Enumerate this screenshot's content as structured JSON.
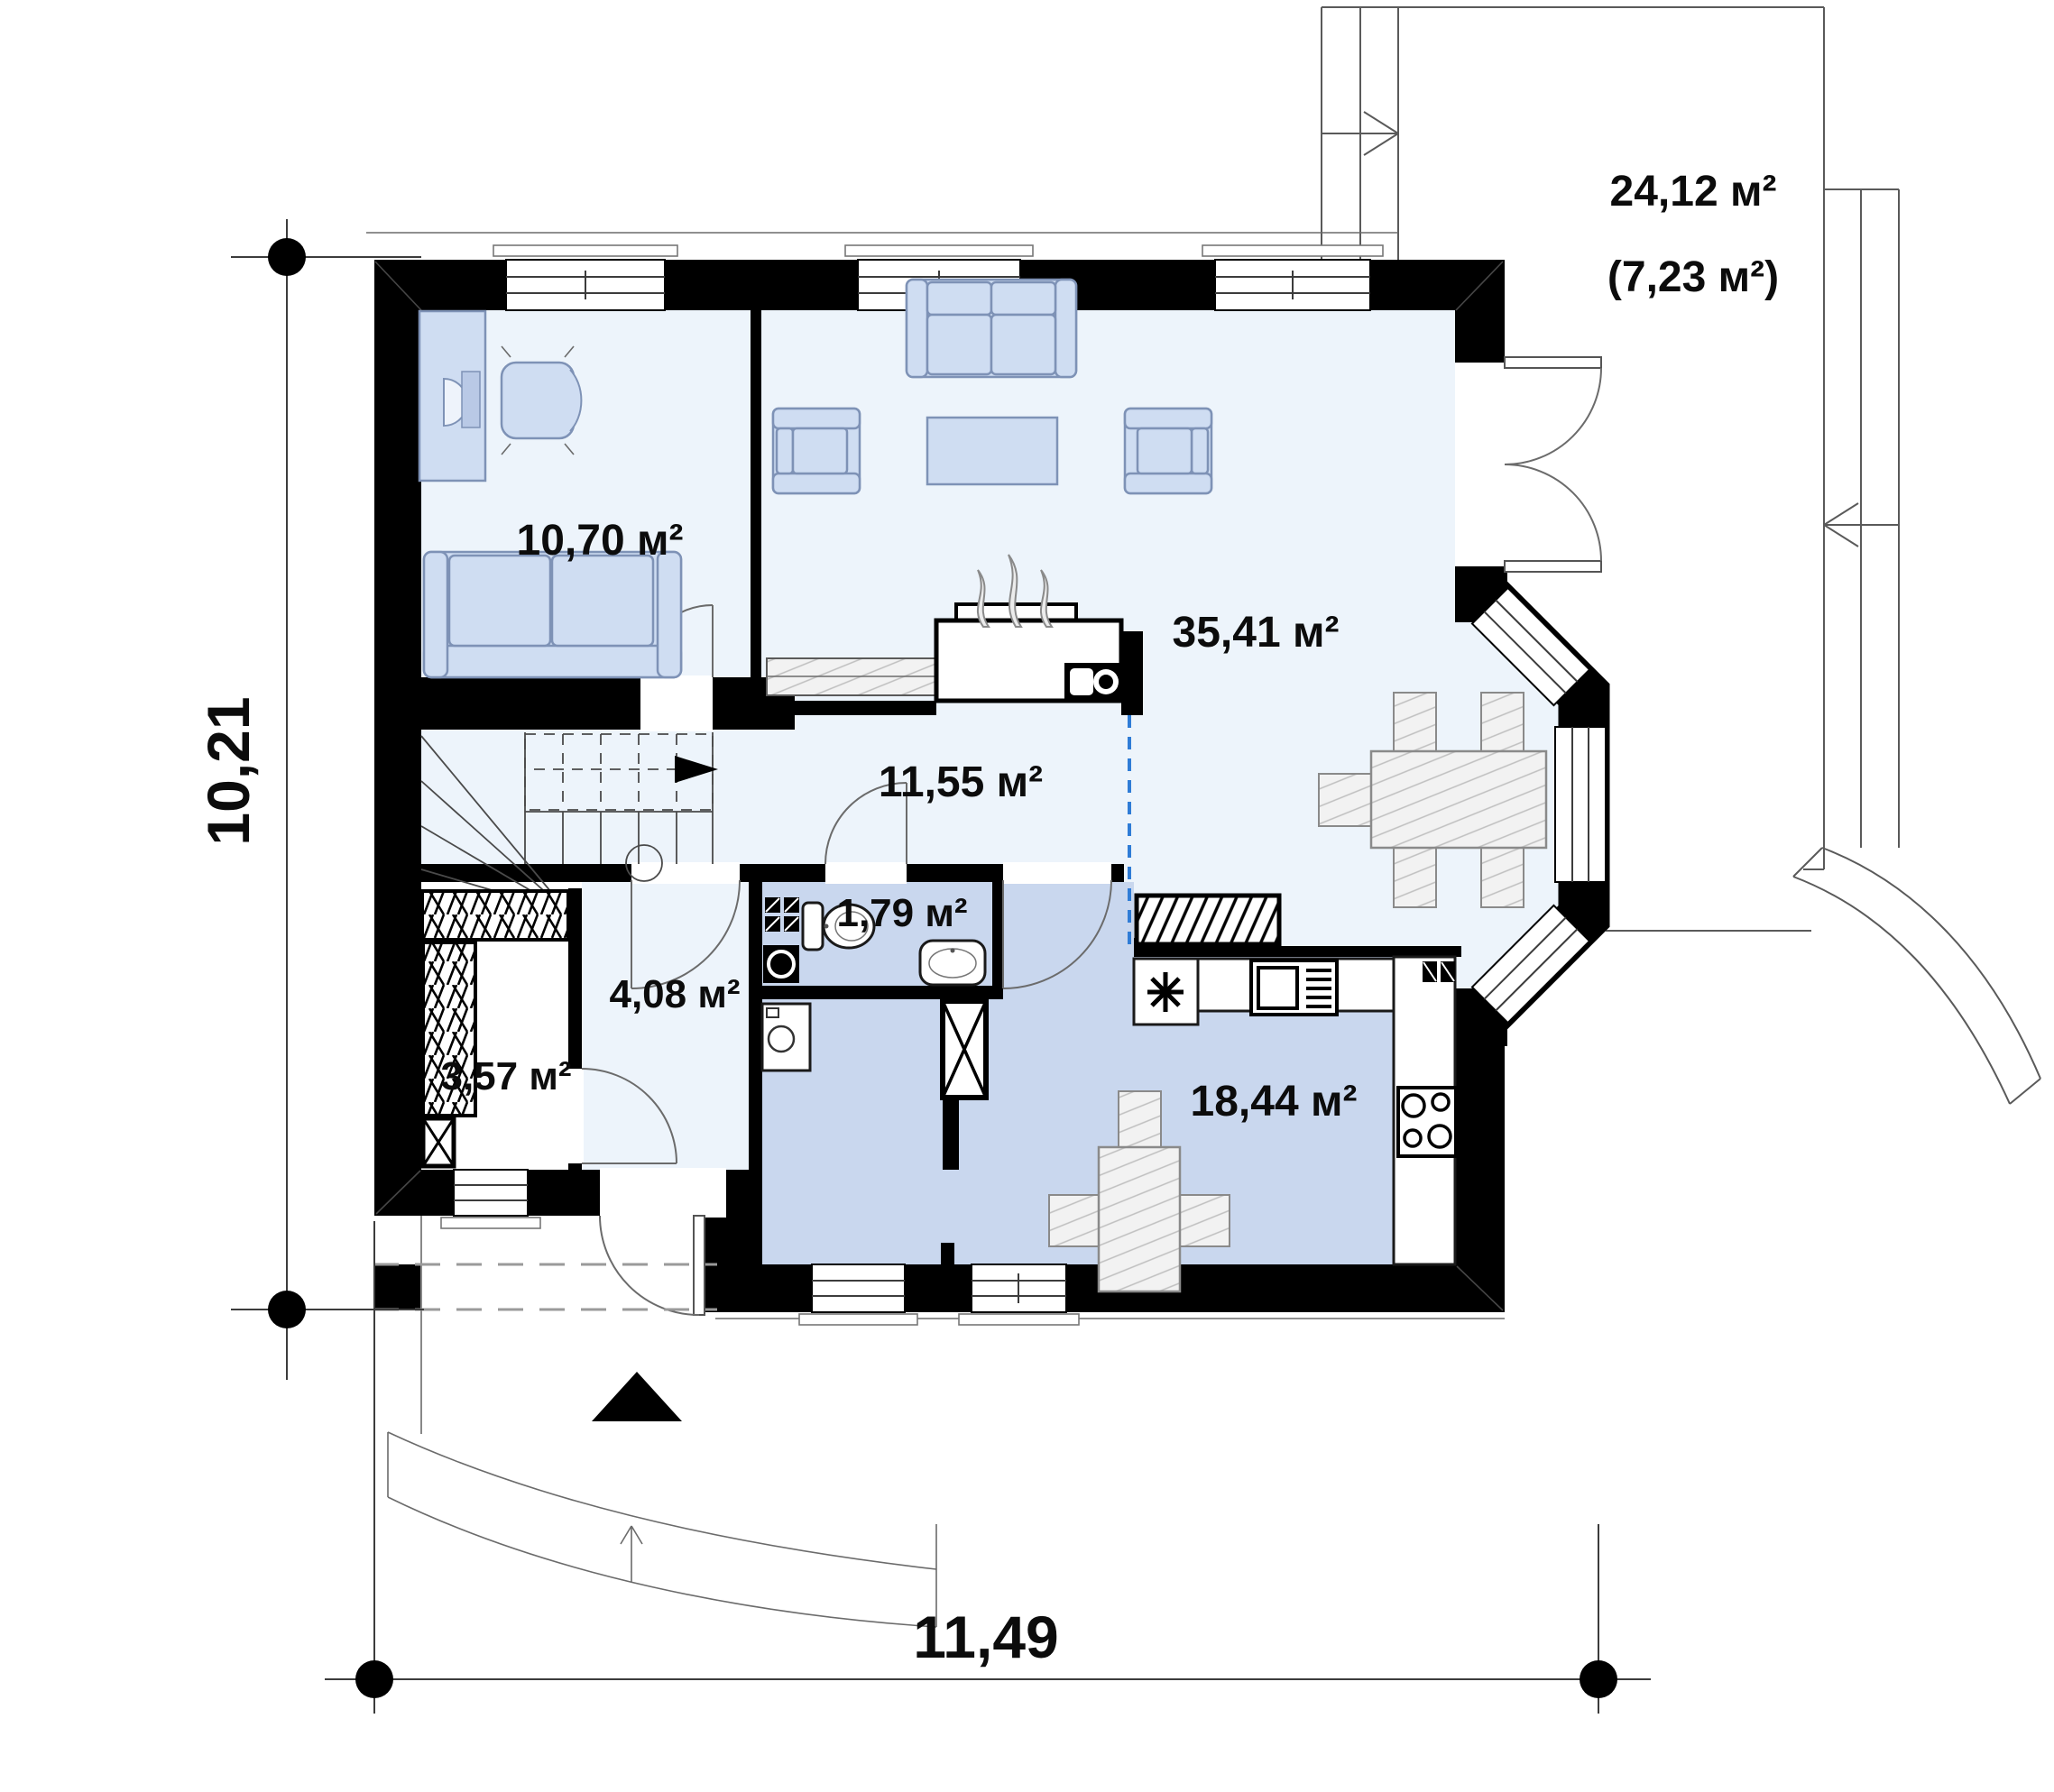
{
  "plan": {
    "title": "first-floor-plan",
    "rooms": [
      {
        "name": "office",
        "area": "10,70 м²"
      },
      {
        "name": "living-room",
        "area": "35,41 м²"
      },
      {
        "name": "hallway-stairs",
        "area": "11,55 м²"
      },
      {
        "name": "wc",
        "area": "1,79 м²"
      },
      {
        "name": "vestibule",
        "area": "4,08 м²"
      },
      {
        "name": "wardrobe",
        "area": "3,57 м²"
      },
      {
        "name": "kitchen",
        "area": "18,44 м²"
      },
      {
        "name": "terrace",
        "area": "24,12 м²",
        "area_secondary": "(7,23 м²)"
      }
    ],
    "dimensions": {
      "overall_width_m": "11,49",
      "overall_depth_m": "10,21"
    },
    "colors": {
      "wall": "#000000",
      "floor_light": "#edf4fb",
      "floor_shaded": "#c9d7ee",
      "furniture_blue": "#cfddf2",
      "room_divider_dashed": "#2f7cd6"
    }
  }
}
